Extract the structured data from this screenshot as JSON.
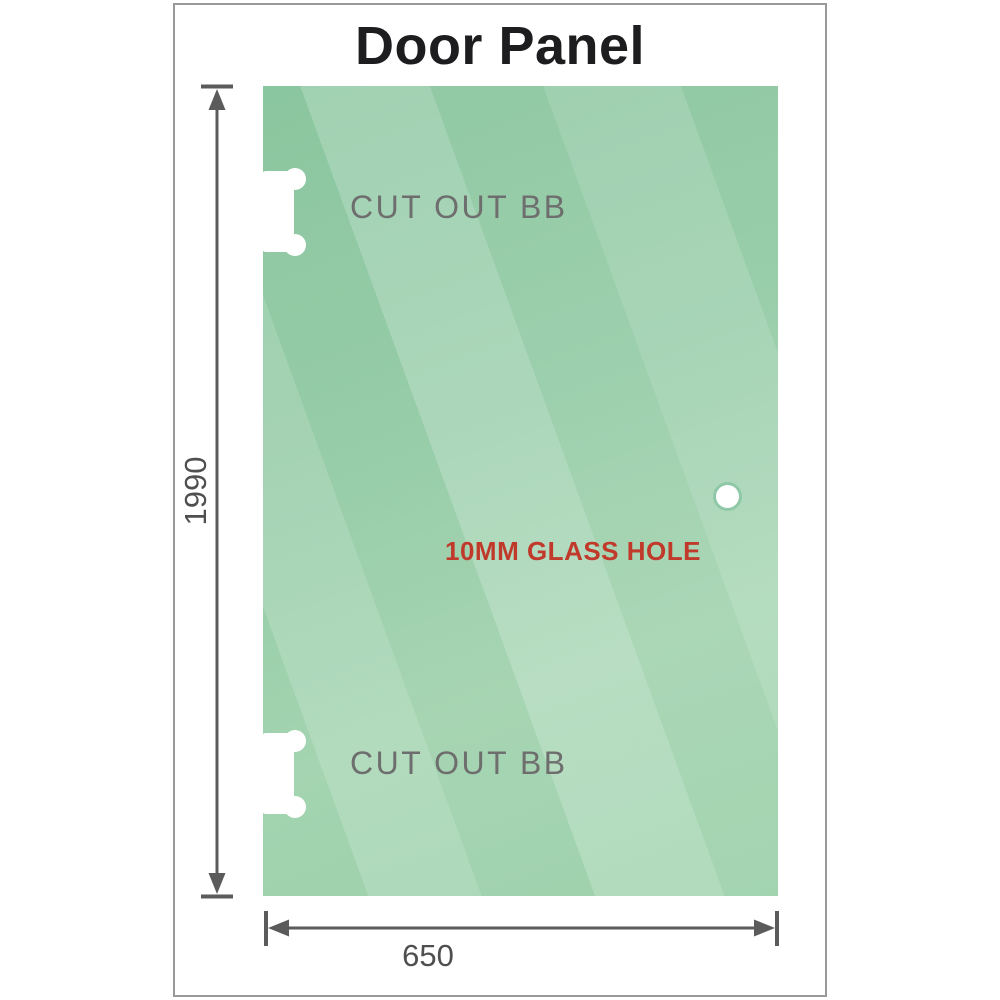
{
  "title": "Door Panel",
  "panel": {
    "cutout_top_label": "CUT OUT BB",
    "cutout_bottom_label": "CUT OUT BB",
    "hole_label": "10MM GLASS HOLE",
    "glass_base_color": "#94cba6",
    "hole_label_color": "#c0392b",
    "label_color": "#6e6e6e"
  },
  "dimensions": {
    "height_label": "1990",
    "width_label": "650",
    "line_color": "#5b5b5b"
  },
  "icons": {
    "hinge_cutout": "white notched hinge cutout shape on left edge",
    "glass_hole": "small white circle",
    "dimension_arrows": "double-headed arrows with end caps"
  }
}
